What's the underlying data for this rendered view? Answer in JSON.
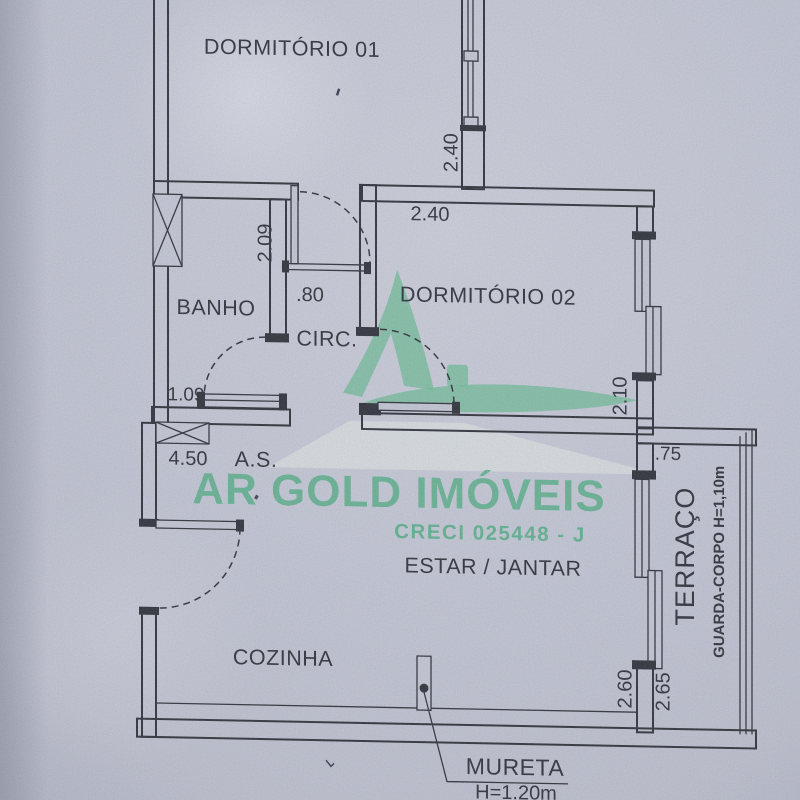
{
  "watermark": {
    "brand": "AR GOLD IMÓVEIS",
    "license": "CRECI 025448 - J"
  },
  "rooms": {
    "dorm1": "DORMITÓRIO 01",
    "dorm2": "DORMITÓRIO 02",
    "banho": "BANHO",
    "circ": "CIRC.",
    "area_servico": "A.S.",
    "estar": "ESTAR / JANTAR",
    "cozinha": "COZINHA",
    "terraco": "TERRAÇO"
  },
  "dimensions": {
    "dorm1_wall": "2.40",
    "dorm2_width": "2.40",
    "banho_depth": "2.09",
    "circ_door": ".80",
    "banho_window": "1.09",
    "service_wall": "4.50",
    "dorm2_depth": "2.10",
    "terraco_top": ".75",
    "estar_wall": "2.60",
    "terraco_wall": "2.65"
  },
  "annotations": {
    "guardrail": "GUARDA-CORPO H=1,10m",
    "mureta_title": "MURETA",
    "mureta_height": "H=1.20m"
  },
  "colors": {
    "paper": "#c7cad7",
    "ink": "#2e3038",
    "brand_green": "#5cb38c"
  }
}
